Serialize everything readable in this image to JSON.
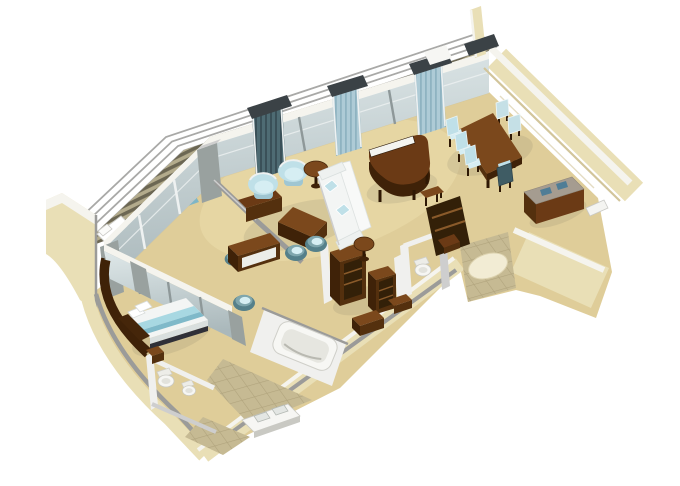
{
  "scene": {
    "description": "3D isometric cutaway floor plan of a luxury ship penthouse suite",
    "view": "isometric-cutaway",
    "background": "#ffffff"
  },
  "colors": {
    "floor": "#dfcd99",
    "floorLight": "#eedfae",
    "railWhite": "#ffffff",
    "railGray": "#a9a9a7",
    "deckDark": "#6c6753",
    "deckLight": "#b3ab8c",
    "wallCream": "#e9dfb6",
    "wallCreamShade": "#d2c59b",
    "wallTop": "#f5f4ee",
    "grayWall": "#9b9b99",
    "grayWallLight": "#cecece",
    "grayPillar": "#99a19f",
    "whiteWall": "#f0f0ee",
    "glassTop": "#dfe8e9",
    "glassBottom": "#aab8bb",
    "frame": "#8e9899",
    "frameLight": "#eef1f1",
    "curtainDark": "#4e6b73",
    "curtainDarkLine": "#3a5058",
    "curtainLight": "#aecbd6",
    "curtainLightLine": "#8fb3c1",
    "valance": "#3b4246",
    "wood": "#6b3a15",
    "woodDark": "#3f2208",
    "woodMid": "#54300e",
    "woodLight": "#7b481c",
    "woodTop": "#8a5424",
    "keys": "#f4f4f0",
    "uphBlue": "#bfe0e8",
    "uphBlueLight": "#d6eef3",
    "uphBlueMid": "#9fc6d2",
    "teal": "#55808a",
    "tealLight": "#7fa6ad",
    "tealDark": "#3f5c64",
    "sofaWhite": "#f3f5f4",
    "sofaShade": "#d9dfde",
    "fixtureWhite": "#f6f6f3",
    "fixtureShade": "#c9c9c3",
    "tile": "#c6ba93",
    "tileLine": "#b0a37c",
    "rug": "#f2ecd4",
    "rugEdge": "#ddd3b0",
    "sideboardTop": "#a59c90",
    "accessoryBlue": "#4f7d96",
    "navy": "#2f3038",
    "bedRunner": "#a8d8e2",
    "bedRunnerDark": "#7fb9c9",
    "closetInterior": "#332008"
  },
  "rooms": [
    {
      "name": "balcony",
      "items": [
        "lounger",
        "lounger",
        "drinks-tray-table",
        "glass-balustrade",
        "teak-deck"
      ]
    },
    {
      "name": "living-room",
      "items": [
        "tub-chair",
        "tub-chair",
        "sofa",
        "coffee-table",
        "round-side-table",
        "round-side-table",
        "grand-piano",
        "piano-side-table",
        "writing-desk",
        "desk-chair",
        "barrel-chair",
        "barrel-chair",
        "console-table"
      ]
    },
    {
      "name": "dining-area",
      "items": [
        "dining-table",
        "dining-chair",
        "dining-chair",
        "dining-chair",
        "dining-chair",
        "dining-chair",
        "dining-chair",
        "sideboard"
      ]
    },
    {
      "name": "bedroom",
      "items": [
        "double-bed",
        "headboard",
        "curved-feature-wall",
        "nightstand",
        "vanity-chair"
      ]
    },
    {
      "name": "bathroom",
      "items": [
        "bathtub",
        "twin-sink-vanity",
        "toilet",
        "bidet",
        "tiled-floor"
      ]
    },
    {
      "name": "guest-toilet",
      "items": [
        "toilet"
      ]
    },
    {
      "name": "wardrobe-hall",
      "items": [
        "open-cabinet",
        "open-cabinet",
        "low-cabinet",
        "low-cabinet"
      ]
    },
    {
      "name": "entry-foyer",
      "items": [
        "oval-rug",
        "tiled-floor",
        "closet-shelves",
        "door"
      ]
    }
  ],
  "counts": {
    "dining_chairs": 6,
    "tub_chairs": 2,
    "barrel_chairs": 3,
    "loungers": 2,
    "curtain_columns": 3,
    "railing_rails": 3
  }
}
